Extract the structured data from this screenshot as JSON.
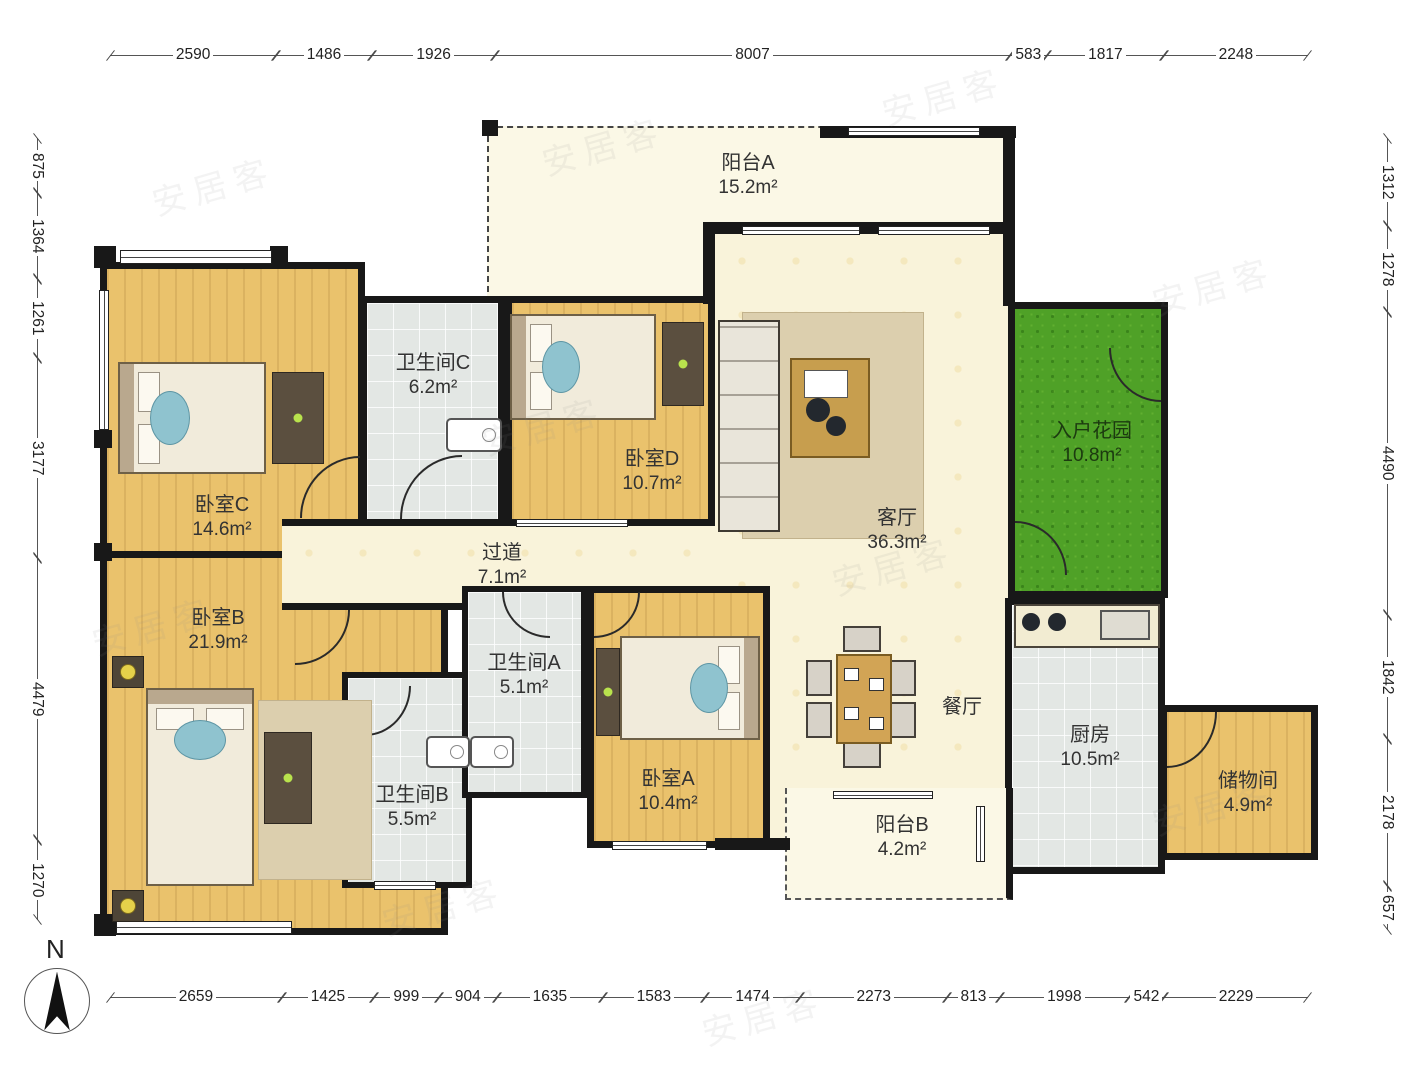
{
  "watermark": "安居客",
  "compass": {
    "north_label": "N"
  },
  "rooms": {
    "balcony_a": {
      "name": "阳台A",
      "area": "15.2m²"
    },
    "bedroom_c": {
      "name": "卧室C",
      "area": "14.6m²"
    },
    "bathroom_c": {
      "name": "卫生间C",
      "area": "6.2m²"
    },
    "bedroom_d": {
      "name": "卧室D",
      "area": "10.7m²"
    },
    "hallway": {
      "name": "过道",
      "area": "7.1m²"
    },
    "living": {
      "name": "客厅",
      "area": "36.3m²"
    },
    "garden": {
      "name": "入户花园",
      "area": "10.8m²"
    },
    "bedroom_b": {
      "name": "卧室B",
      "area": "21.9m²"
    },
    "bathroom_a": {
      "name": "卫生间A",
      "area": "5.1m²"
    },
    "bathroom_b": {
      "name": "卫生间B",
      "area": "5.5m²"
    },
    "bedroom_a": {
      "name": "卧室A",
      "area": "10.4m²"
    },
    "dining": {
      "name": "餐厅"
    },
    "kitchen": {
      "name": "厨房",
      "area": "10.5m²"
    },
    "storage": {
      "name": "储物间",
      "area": "4.9m²"
    },
    "balcony_b": {
      "name": "阳台B",
      "area": "4.2m²"
    }
  },
  "dimensions": {
    "top": [
      2590,
      1486,
      1926,
      8007,
      583,
      1817,
      2248
    ],
    "bottom": [
      2659,
      1425,
      999,
      904,
      1635,
      1583,
      1474,
      2273,
      813,
      1998,
      542,
      2229
    ],
    "left": [
      875,
      1364,
      1261,
      3177,
      4479,
      1270
    ],
    "right": [
      1312,
      1278,
      4490,
      1842,
      2178,
      657
    ]
  }
}
